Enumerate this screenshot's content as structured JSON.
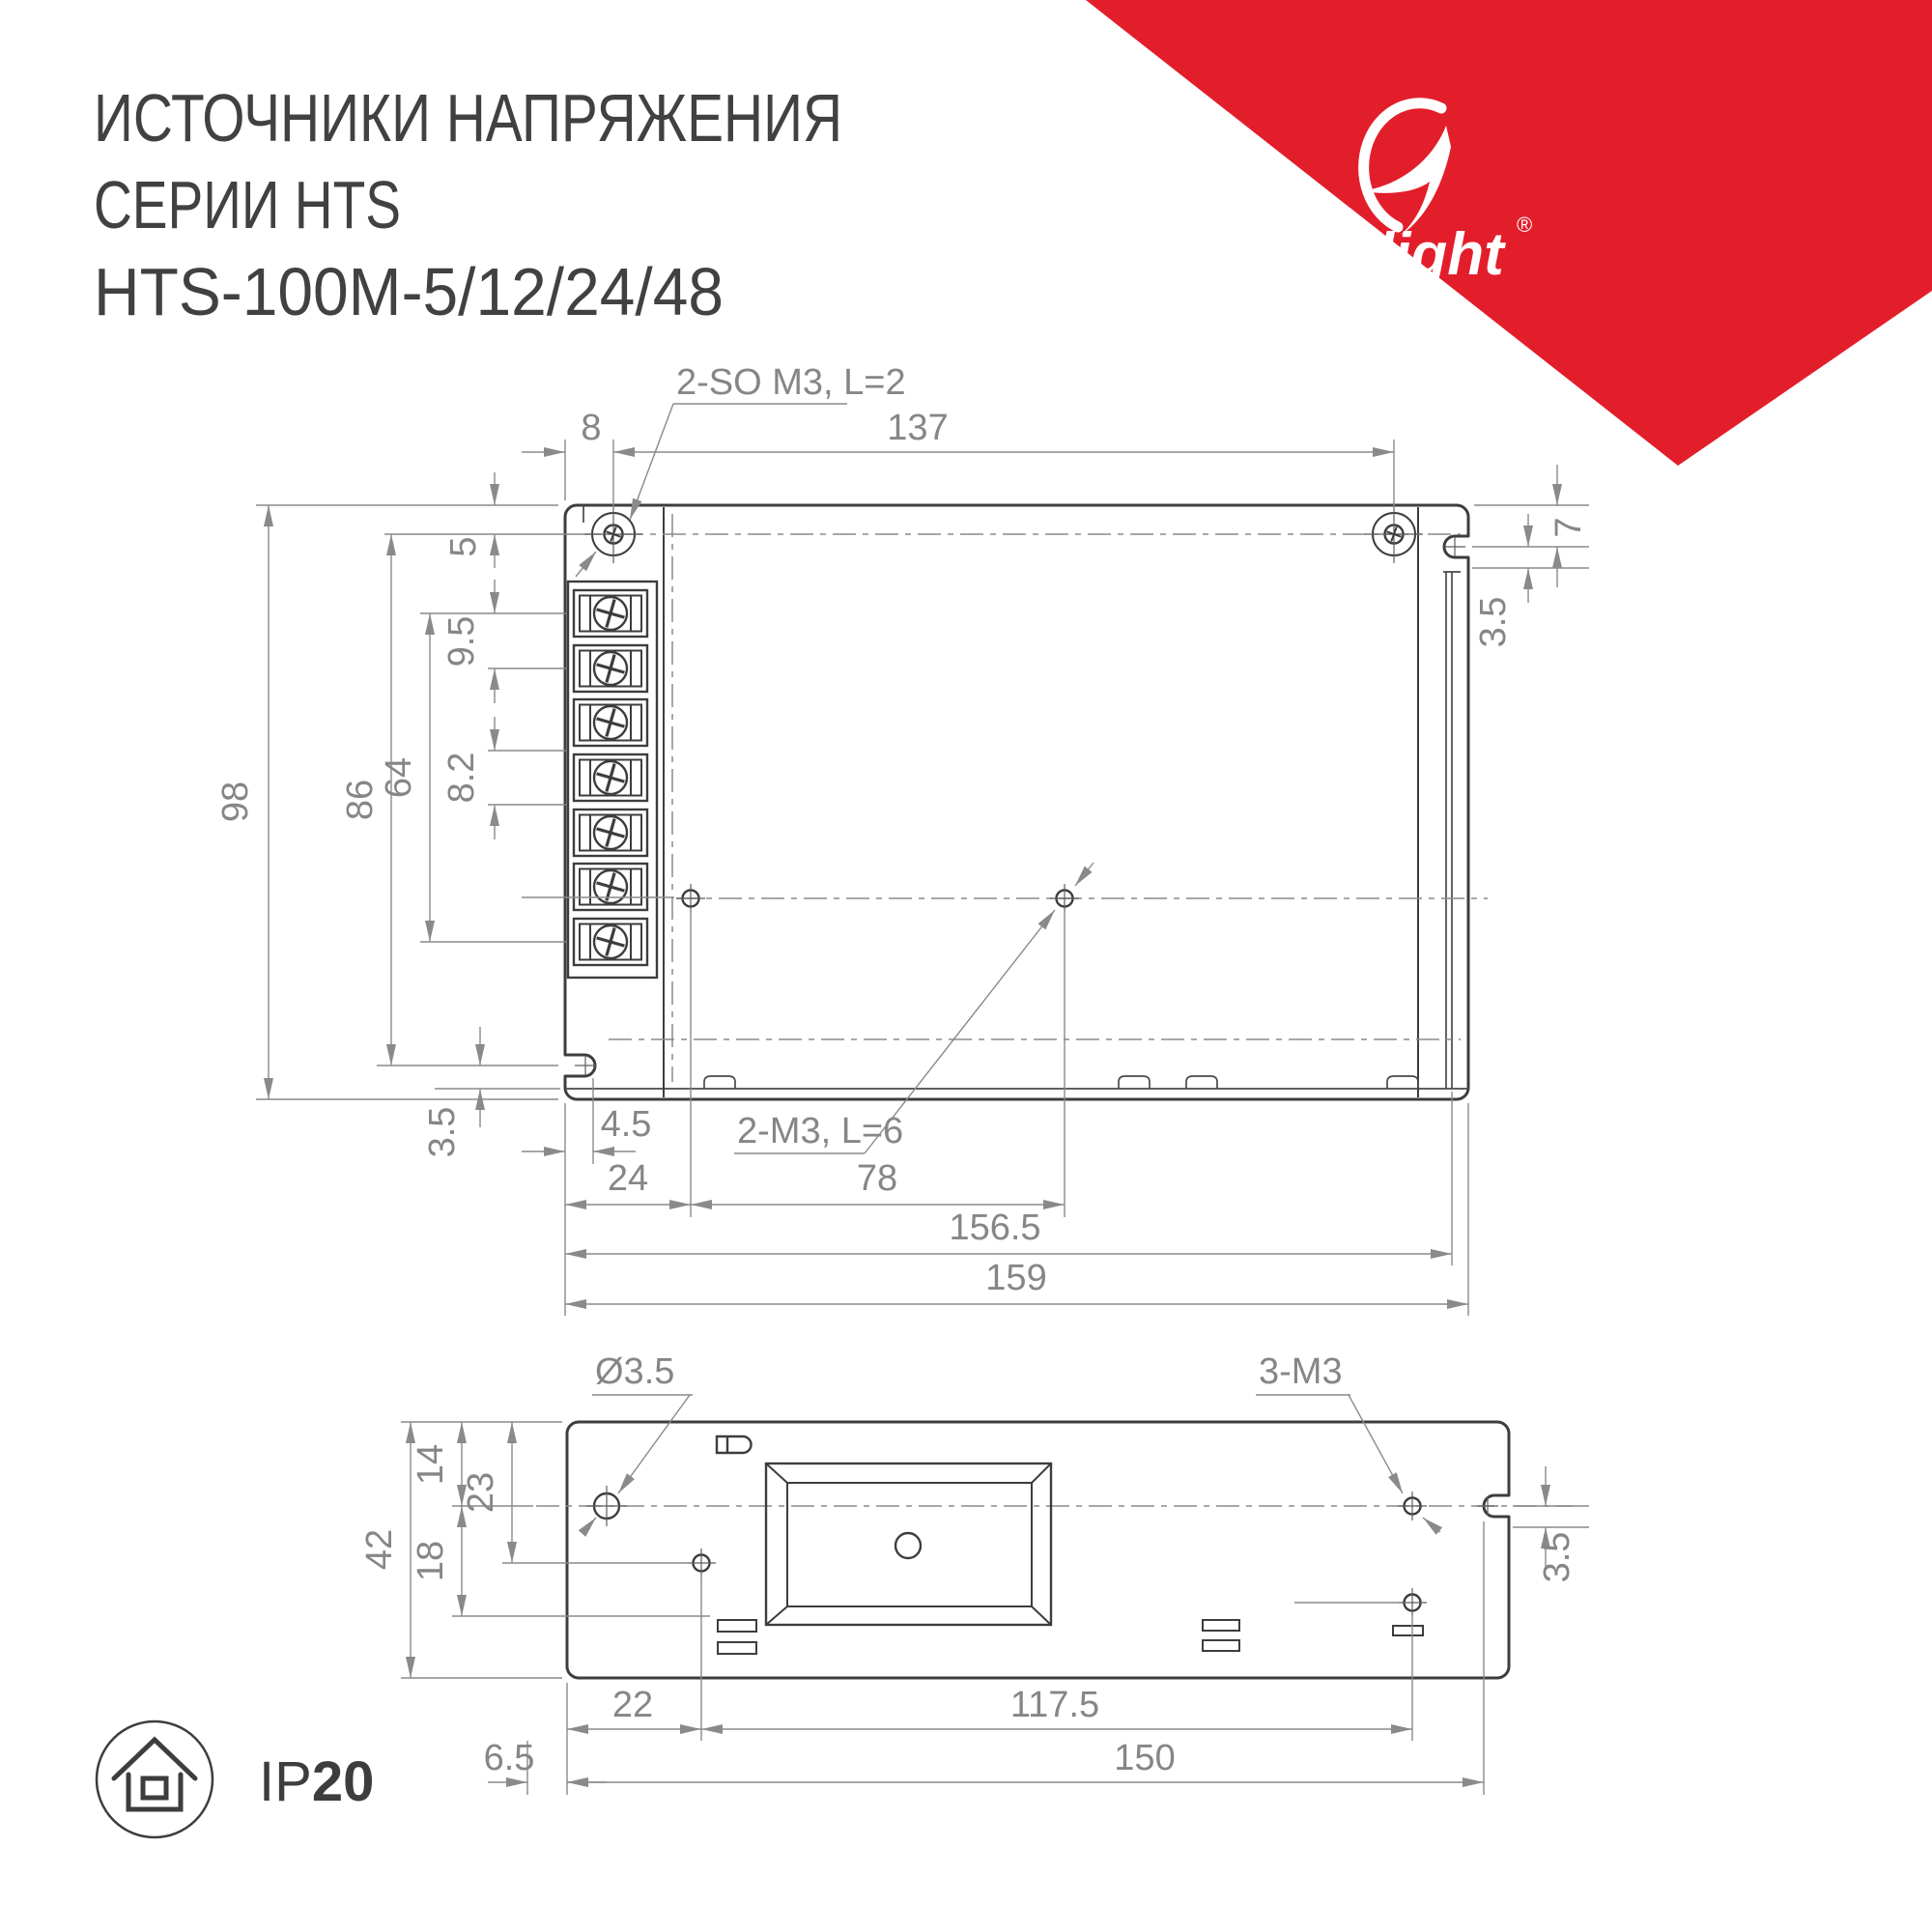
{
  "title": {
    "line1": "ИСТОЧНИКИ НАПРЯЖЕНИЯ",
    "line2": "СЕРИИ HTS",
    "line3": "HTS-100M-5/12/24/48"
  },
  "logo": {
    "brand": "arlight",
    "registered": "®"
  },
  "badge": {
    "ip_prefix": "IP",
    "ip_value": "20"
  },
  "callouts": {
    "top_screws": "2-SO M3, L=2",
    "top_holes": "2-M3, L=6",
    "bottom_hole_diameter": "Ø3.5",
    "bottom_holes": "3-M3"
  },
  "dims": {
    "top": {
      "screw_offset": "8",
      "screw_spacing": "137",
      "screw_line_offset": "5",
      "terminal_pitch_a": "9.5",
      "terminal_span": "64",
      "terminal_pitch_b": "8.2",
      "height_total": "98",
      "height_screw_to_notch": "86",
      "left_notch_to_edge": "3.5",
      "right_notch_offset": "7",
      "right_step": "3.5",
      "left_notch_depth": "4.5",
      "hole_offset": "24",
      "hole_spacing": "78",
      "width_inner": "156.5",
      "width_total": "159"
    },
    "bottom": {
      "centerline_offset": "14",
      "second_hole_offset": "23",
      "height_total": "42",
      "vent_offset": "18",
      "right_step": "3.5",
      "hole_offset": "22",
      "hole_spacing": "117.5",
      "edge_offset": "6.5",
      "width_span": "150"
    }
  },
  "colors": {
    "accent_red": "#e31e2b",
    "drawing_dark": "#3d3d3d",
    "dimension_gray": "#8a8a8a",
    "dimension_text": "#868686",
    "title_text": "#414042"
  }
}
